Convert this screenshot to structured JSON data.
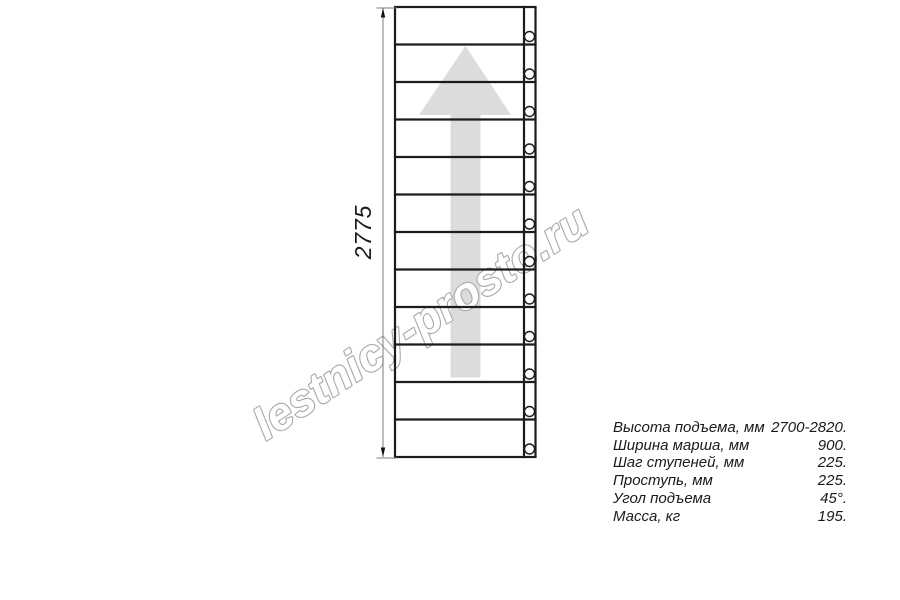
{
  "watermark": {
    "text": "lestnicy-prosto.ru"
  },
  "dimension": {
    "label": "2775"
  },
  "drawing": {
    "tread_count": 12,
    "line_color": "#1c1c1c",
    "dim_color": "#7d7d7d",
    "arrow_color": "#dcdcdc",
    "watermark_stroke": "#ababab",
    "bolt_count": 12
  },
  "specs": {
    "rows": [
      {
        "label": "Высота подъема, мм",
        "value": "2700-2820."
      },
      {
        "label": "Ширина марша, мм",
        "value": "900."
      },
      {
        "label": "Шаг ступеней, мм",
        "value": "225."
      },
      {
        "label": "Проступь, мм",
        "value": "225."
      },
      {
        "label": "Угол подъема",
        "value": "45°."
      },
      {
        "label": "Масса, кг",
        "value": "195."
      }
    ]
  }
}
